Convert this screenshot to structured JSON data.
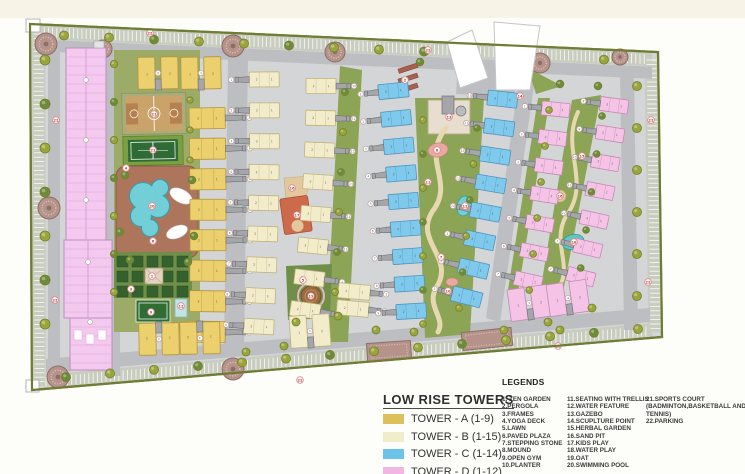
{
  "low_rise_towers": {
    "title": "LOW RISE TOWERS",
    "items": [
      {
        "label": "TOWER - A (1-9)",
        "color": "#ddc05c"
      },
      {
        "label": "TOWER - B (1-15)",
        "color": "#f1ecc9"
      },
      {
        "label": "TOWER - C (1-14)",
        "color": "#6cc3ea"
      },
      {
        "label": "TOWER - D (1-12)",
        "color": "#f0b7e0"
      }
    ]
  },
  "legends": {
    "title": "LEGENDS",
    "columns": [
      [
        "1. ZEN GARDEN",
        "2.PERGOLA",
        "3.FRAMES",
        "4.YOGA DECK",
        "5.LAWN",
        "6.PAVED PLAZA",
        "7.STEPPING STONE",
        "8.MOUND",
        "9.OPEN GYM",
        "10.PLANTER"
      ],
      [
        "11.SEATING WITH TRELLIS",
        "12.WATER FEATURE",
        "13.GAZEBO",
        "14.SCUPLTURE POINT",
        "15.HERBAL GARDEN",
        "16.SAND PIT",
        "17.KIDS PLAY",
        "18.WATER PLAY",
        "19.OAT",
        "20.SWIMMING POOL"
      ],
      [
        "21.SPORTS COURT",
        "(BADMINTON,BASKETBALL AND",
        "TENNIS)",
        "22.PARKING"
      ]
    ]
  },
  "site": {
    "tower_groups": [
      {
        "id": "A",
        "count": 9
      },
      {
        "id": "B",
        "count": 15
      },
      {
        "id": "C",
        "count": 14
      },
      {
        "id": "D",
        "count": 12
      }
    ],
    "markers": [
      {
        "n": "21",
        "x": 154,
        "y": 114
      },
      {
        "n": "21",
        "x": 153,
        "y": 150
      },
      {
        "n": "20",
        "x": 152,
        "y": 206
      },
      {
        "n": "4",
        "x": 126,
        "y": 168
      },
      {
        "n": "6",
        "x": 153,
        "y": 241
      },
      {
        "n": "1",
        "x": 152,
        "y": 276
      },
      {
        "n": "9",
        "x": 151,
        "y": 312
      },
      {
        "n": "3",
        "x": 131,
        "y": 289
      },
      {
        "n": "2",
        "x": 405,
        "y": 80
      },
      {
        "n": "13",
        "x": 449,
        "y": 117
      },
      {
        "n": "8",
        "x": 437,
        "y": 150
      },
      {
        "n": "11",
        "x": 428,
        "y": 182
      },
      {
        "n": "12",
        "x": 465,
        "y": 206
      },
      {
        "n": "7",
        "x": 441,
        "y": 257
      },
      {
        "n": "10",
        "x": 448,
        "y": 291
      },
      {
        "n": "5",
        "x": 303,
        "y": 280
      },
      {
        "n": "19",
        "x": 311,
        "y": 296
      },
      {
        "n": "17",
        "x": 297,
        "y": 215
      },
      {
        "n": "16",
        "x": 292,
        "y": 188
      },
      {
        "n": "18",
        "x": 574,
        "y": 242
      },
      {
        "n": "15",
        "x": 582,
        "y": 156
      },
      {
        "n": "14",
        "x": 520,
        "y": 96
      },
      {
        "n": "16",
        "x": 560,
        "y": 196
      },
      {
        "n": "12",
        "x": 181,
        "y": 306
      },
      {
        "n": "22",
        "x": 150,
        "y": 33
      },
      {
        "n": "22",
        "x": 428,
        "y": 50
      },
      {
        "n": "22",
        "x": 651,
        "y": 120
      },
      {
        "n": "22",
        "x": 648,
        "y": 282
      },
      {
        "n": "22",
        "x": 56,
        "y": 120
      },
      {
        "n": "22",
        "x": 55,
        "y": 300
      },
      {
        "n": "22",
        "x": 300,
        "y": 380
      },
      {
        "n": "22",
        "x": 558,
        "y": 346
      }
    ],
    "colors": {
      "boundary": "#6f7d34",
      "pavement": "#d4d5d7",
      "road": "#bcbec1",
      "parkband": "#c9cdbf",
      "hatch": "#ffffff",
      "green": "#8ca455",
      "greenLight": "#9cab68",
      "greenDark": "#6f8f49",
      "lawnDark": "#35612f",
      "towerA": "#ecd06d",
      "towerAEdge": "#b3953a",
      "towerB": "#f2ecca",
      "towerBEdge": "#bfb37e",
      "towerC": "#7fcaec",
      "towerCEdge": "#4f93bb",
      "towerD": "#f4c3e6",
      "towerDEdge": "#c488b4",
      "highrise": "#f4c9ef",
      "highriseEdge": "#c08cbc",
      "highriseLine": "#dba6d6",
      "core": "#a5a6aa",
      "coreEdge": "#707175",
      "pool": "#72cfd8",
      "poolEdge": "#2f9fae",
      "deck": "#ad765c",
      "deckEdge": "#8a5a42",
      "courtBall": "#c9a36a",
      "courtBallKey": "#b5814f",
      "courtBand": "#a9ad79",
      "courtTennis": "#2f6b35",
      "courtTennisBand": "#7ba043",
      "mandala": "#b5938b",
      "mandalaEdge": "#8b6e66",
      "mandalaIn": "#d8bdb2",
      "treeFill": "#9aa63c",
      "treeEdge": "#74802a",
      "treeDark": "#6d8c3a",
      "kids": "#cd6a4c",
      "kidsEdge": "#a94f36",
      "sand": "#e2c89c",
      "oat": "#9a6b3f",
      "mound": "#e8a9a0",
      "path": "#e7d8b2",
      "markerEdge": "#e08a8a",
      "markerText": "#b24040",
      "clubhouse": "#e8ded0",
      "clubhouseEdge": "#b9a98f"
    }
  }
}
